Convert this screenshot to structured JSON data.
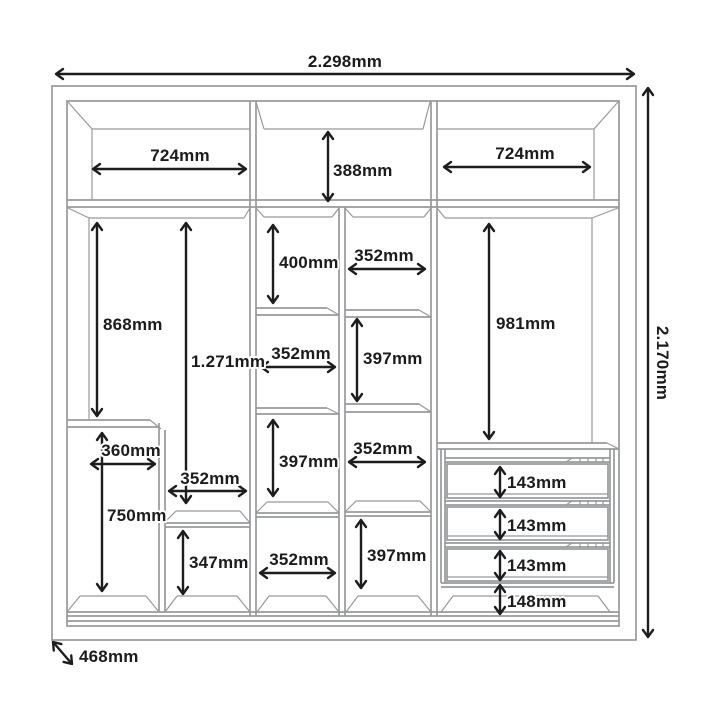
{
  "diagram": {
    "type": "wardrobe-internal-dimensions",
    "unit": "mm",
    "colors": {
      "dimension": "#1d1d1f",
      "structure": "#97999c",
      "background": "#ffffff"
    },
    "overall": {
      "width": "2.298mm",
      "height": "2.170mm",
      "depth": "468mm"
    },
    "top_row": {
      "left_width": "724mm",
      "center_height": "388mm",
      "right_width": "724mm"
    },
    "left_column": {
      "hanging_height": "868mm",
      "full_height": "1.271mm",
      "cabinet_width": "360mm",
      "cabinet_height": "750mm",
      "shelf_width": "352mm",
      "lower_cubby_height": "347mm"
    },
    "center_left_column": {
      "cubby1_height": "400mm",
      "cubby2_width": "352mm",
      "cubby3_height": "397mm",
      "cubby4_width": "352mm"
    },
    "center_right_column": {
      "cubby1_width": "352mm",
      "cubby2_height": "397mm",
      "cubby3_width": "352mm",
      "cubby4_height": "397mm"
    },
    "right_column": {
      "hanging_height": "981mm",
      "drawer1_height": "143mm",
      "drawer2_height": "143mm",
      "drawer3_height": "143mm",
      "base_gap_height": "148mm"
    }
  }
}
